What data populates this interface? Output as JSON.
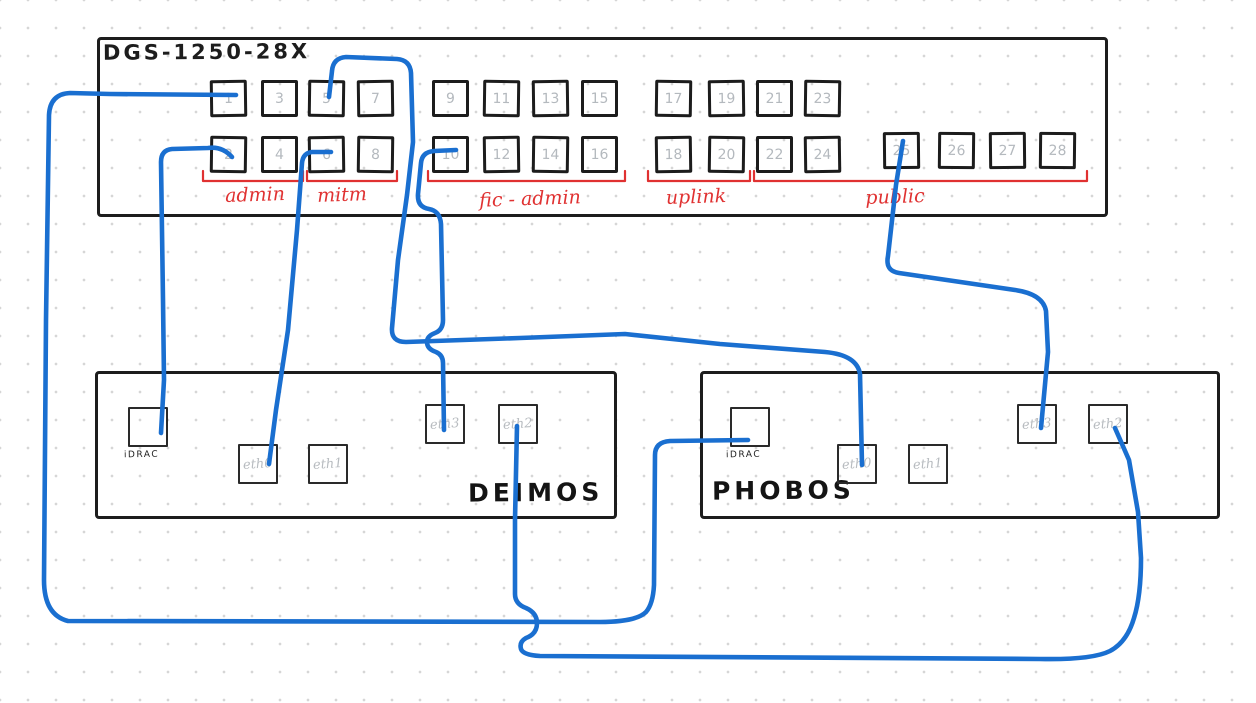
{
  "diagram_type": "hand-drawn network cabling diagram",
  "switch": {
    "title": "DGS-1250-28X",
    "ports_top_row": [
      1,
      3,
      5,
      7,
      9,
      11,
      13,
      15,
      17,
      19,
      21,
      23
    ],
    "ports_bottom_row": [
      2,
      4,
      6,
      8,
      10,
      12,
      14,
      16,
      18,
      20,
      22,
      24
    ],
    "ports_extra_row": [
      25,
      26,
      27,
      28
    ],
    "port_groups": [
      {
        "label": "admin",
        "ports": "1-4"
      },
      {
        "label": "mitm",
        "ports": "5-8"
      },
      {
        "label": "fic - admin",
        "ports": "9-16"
      },
      {
        "label": "uplink",
        "ports": "17-20"
      },
      {
        "label": "public",
        "ports": "21-28"
      }
    ]
  },
  "servers": [
    {
      "name": "DEIMOS",
      "idrac_label": "iDRAC",
      "ports": [
        "iDRAC",
        "eth0",
        "eth1",
        "eth3",
        "eth2"
      ]
    },
    {
      "name": "PHOBOS",
      "idrac_label": "iDRAC",
      "ports": [
        "iDRAC",
        "eth0",
        "eth1",
        "eth3",
        "eth2"
      ]
    }
  ],
  "connections": [
    {
      "id": "c1",
      "from": "DGS-1250-28X port 1",
      "to": "PHOBOS iDRAC"
    },
    {
      "id": "c2",
      "from": "DGS-1250-28X port 2",
      "to": "DEIMOS iDRAC"
    },
    {
      "id": "c3",
      "from": "DGS-1250-28X port 5",
      "to": "PHOBOS eth0"
    },
    {
      "id": "c4",
      "from": "DGS-1250-28X port 6",
      "to": "DEIMOS eth0"
    },
    {
      "id": "c5",
      "from": "DGS-1250-28X port 10",
      "to": "DEIMOS eth3"
    },
    {
      "id": "c6",
      "from": "DGS-1250-28X port 25",
      "to": "PHOBOS eth3"
    },
    {
      "id": "c7",
      "from": "DEIMOS eth2",
      "to": "PHOBOS eth2"
    }
  ],
  "colors": {
    "ink": "#1d1d1d",
    "port_number_gray": "#b4b9be",
    "group_label_red": "#e03131",
    "cable_blue": "#1a6fd0",
    "canvas_background": "#ffffff",
    "grid_dot": "#d6d6d6"
  }
}
